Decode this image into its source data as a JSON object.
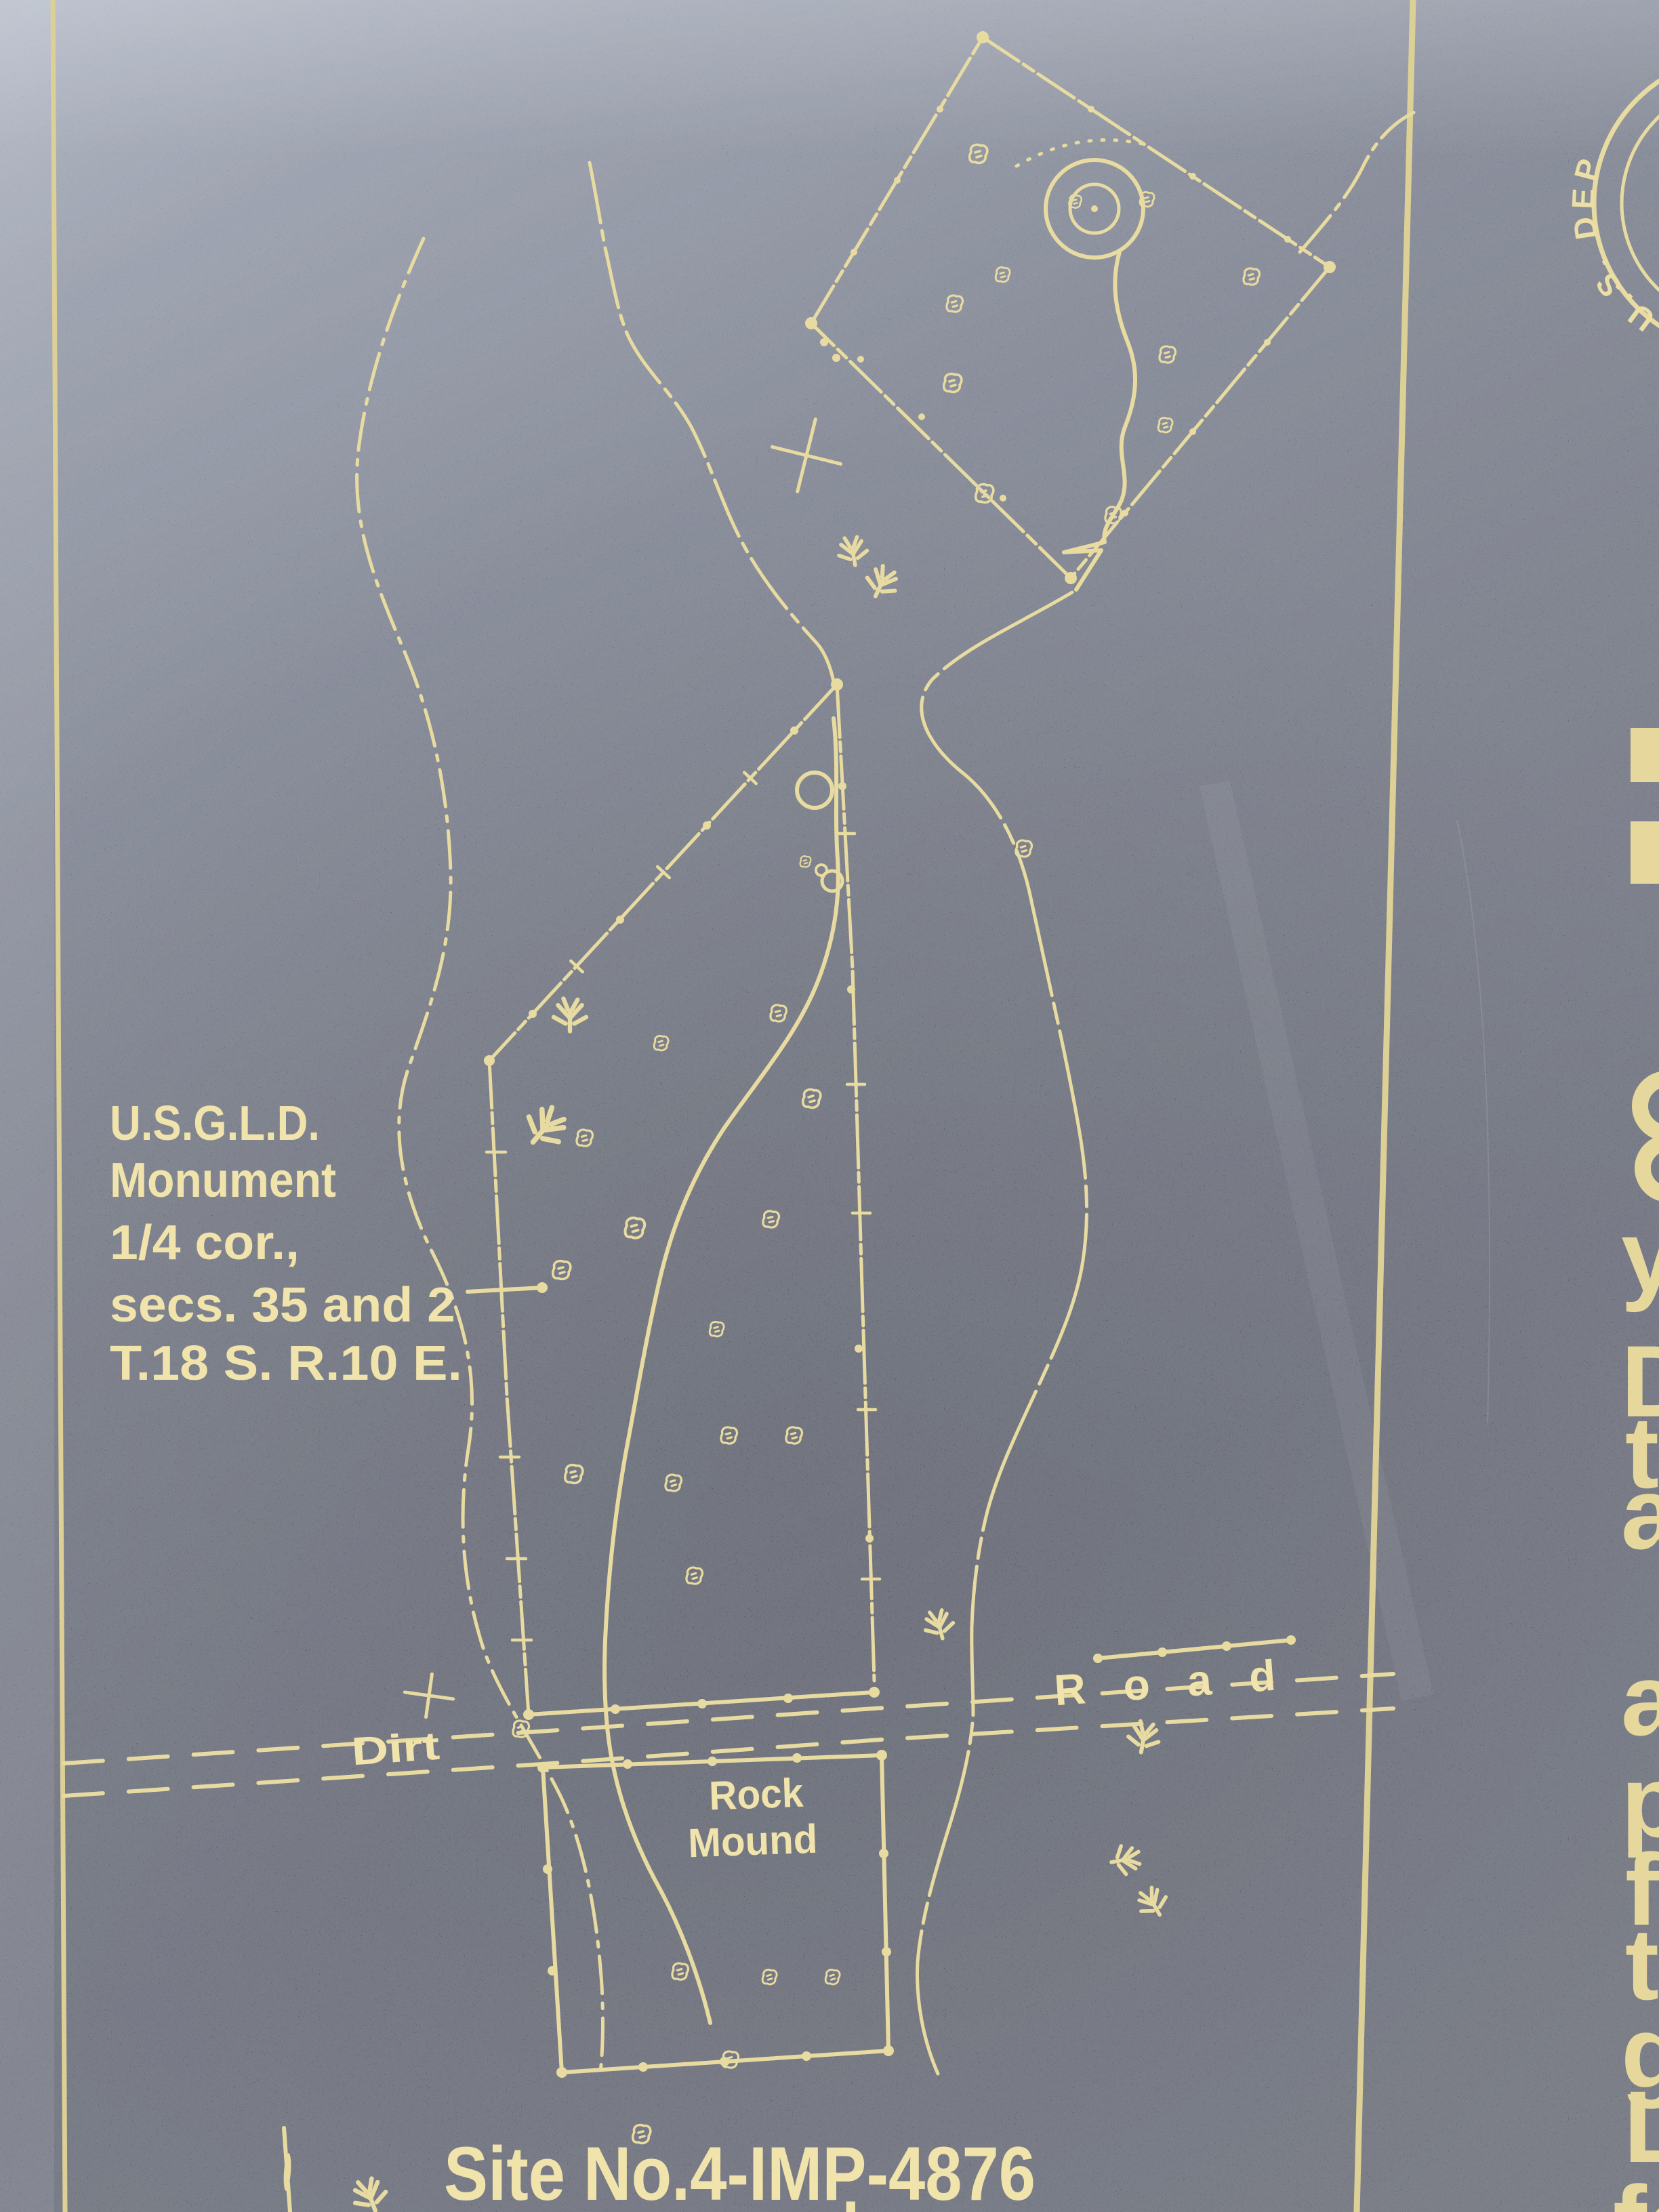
{
  "photo": {
    "description": "Engraved metal plaque photograph of an archaeological site survey map",
    "background_color": "#565b68",
    "background_light": "#939aab",
    "background_dark": "#44485a",
    "ink_color": "#e8dba1",
    "text_color": "#f0e3ab"
  },
  "seal": {
    "arc_text": "U.S. DEP"
  },
  "right_panel": {
    "partial_letters": [
      "y",
      "D",
      "t",
      "a",
      "a",
      "p",
      "f",
      "t",
      "g",
      "L",
      "fo"
    ],
    "fragment_shapes": [
      "bar",
      "bar",
      "c",
      "c"
    ]
  },
  "map": {
    "monument_note": {
      "lines": [
        "U.S.G.L.D.",
        "Monument",
        "1/4 cor.,",
        "secs. 35 and 2",
        "T.18 S. R.10 E."
      ]
    },
    "road": {
      "label_left": "Dirt",
      "label_right": "Road"
    },
    "rock_mound_label": {
      "line1": "Rock",
      "line2": "Mound"
    },
    "site_label": "Site No.4-IMP-4876",
    "bottom_edge_partial": "key",
    "symbols": [
      "rock-symbol",
      "bush-symbol",
      "survey-cross-symbol",
      "quarter-corner-bar",
      "boundary-dot",
      "tick-mark"
    ]
  }
}
